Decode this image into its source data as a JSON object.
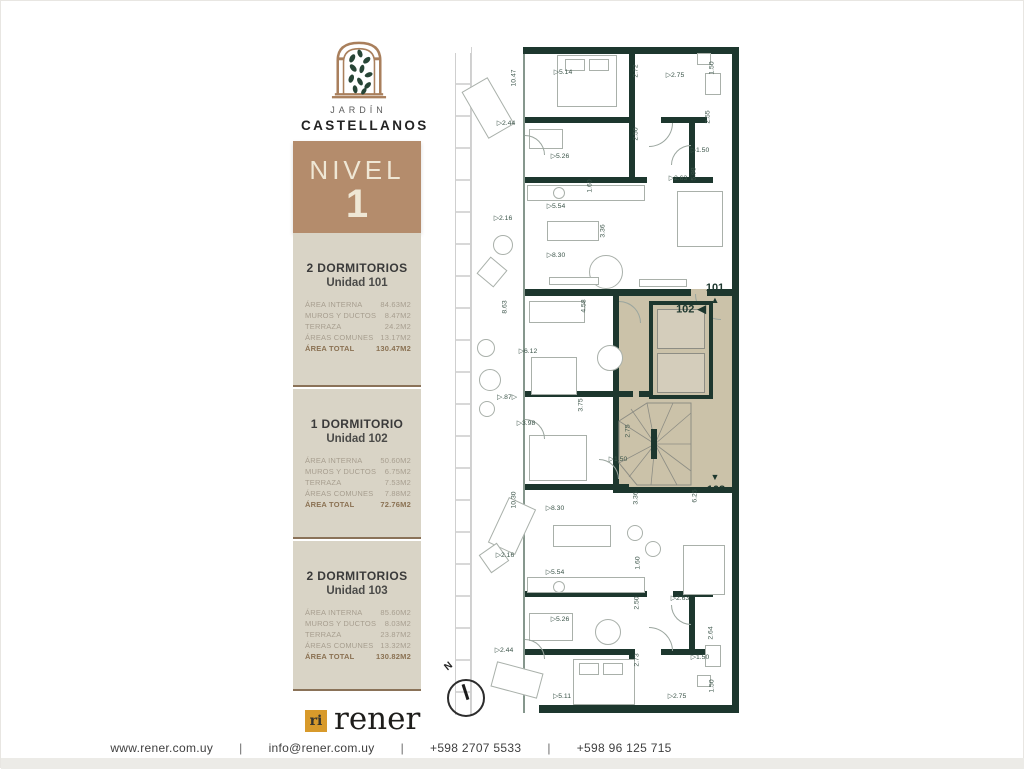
{
  "brand": {
    "name_top": "JARDÍN",
    "name_bottom": "CASTELLANOS"
  },
  "level_badge": {
    "label": "NIVEL",
    "number": "1",
    "bg": "#b48c6c"
  },
  "units": [
    {
      "title": "2 DORMITORIOS",
      "subtitle": "Unidad 101",
      "rows": [
        {
          "label": "ÁREA INTERNA",
          "value": "84.63m2"
        },
        {
          "label": "MUROS Y DUCTOS",
          "value": "8.47m2"
        },
        {
          "label": "TERRAZA",
          "value": "24.2m2"
        },
        {
          "label": "ÁREAS COMUNES",
          "value": "13.17m2"
        }
      ],
      "total": {
        "label": "ÁREA TOTAL",
        "value": "130.47m2"
      }
    },
    {
      "title": "1 DORMITORIO",
      "subtitle": "Unidad 102",
      "rows": [
        {
          "label": "ÁREA INTERNA",
          "value": "50.60m2"
        },
        {
          "label": "MUROS Y DUCTOS",
          "value": "6.75m2"
        },
        {
          "label": "TERRAZA",
          "value": "7.53m2"
        },
        {
          "label": "ÁREAS COMUNES",
          "value": "7.88m2"
        }
      ],
      "total": {
        "label": "ÁREA TOTAL",
        "value": "72.76m2"
      }
    },
    {
      "title": "2 DORMITORIOS",
      "subtitle": "Unidad 103",
      "rows": [
        {
          "label": "ÁREA INTERNA",
          "value": "85.60m2"
        },
        {
          "label": "MUROS Y DUCTOS",
          "value": "8.03m2"
        },
        {
          "label": "TERRAZA",
          "value": "23.87m2"
        },
        {
          "label": "ÁREAS COMUNES",
          "value": "13.32m2"
        }
      ],
      "total": {
        "label": "ÁREA TOTAL",
        "value": "130.82m2"
      }
    }
  ],
  "footer_logo": {
    "mark": "ri",
    "name": "rener",
    "square_color": "#d89a2b"
  },
  "footer": {
    "separator": "|",
    "items": [
      "www.rener.com.uy",
      "info@rener.com.uy",
      "+598 2707 5533",
      "+598 96 125 715"
    ]
  },
  "floorplan": {
    "wall_color": "#1d372e",
    "highlight_color": "#cbc2a9",
    "compass_label": "N",
    "markers": [
      {
        "label": "101",
        "x": 262,
        "y": 249,
        "arrow": "▲",
        "ax": 262,
        "ay": 261
      },
      {
        "label": "102 ◀",
        "x": 238,
        "y": 270,
        "arrow": "",
        "ax": 0,
        "ay": 0
      },
      {
        "label": "103",
        "x": 263,
        "y": 451,
        "arrow": "▼",
        "ax": 262,
        "ay": 438
      }
    ],
    "dimensions": [
      {
        "t": "10.47",
        "x": 61,
        "y": 39,
        "v": true
      },
      {
        "t": "▷5.14",
        "x": 110,
        "y": 33,
        "v": false
      },
      {
        "t": "2.72",
        "x": 183,
        "y": 32,
        "v": true
      },
      {
        "t": "▷2.75",
        "x": 222,
        "y": 36,
        "v": false
      },
      {
        "t": "1.50",
        "x": 259,
        "y": 29,
        "v": true
      },
      {
        "t": "▷2.44",
        "x": 53,
        "y": 84,
        "v": false
      },
      {
        "t": "2.50",
        "x": 183,
        "y": 95,
        "v": true
      },
      {
        "t": "▷5.26",
        "x": 107,
        "y": 117,
        "v": false
      },
      {
        "t": "2.55",
        "x": 255,
        "y": 78,
        "v": true
      },
      {
        "t": "▷1.50",
        "x": 247,
        "y": 111,
        "v": false
      },
      {
        "t": "5.98",
        "x": 241,
        "y": 135,
        "v": true
      },
      {
        "t": "▷2.63",
        "x": 225,
        "y": 139,
        "v": false
      },
      {
        "t": "1.60",
        "x": 137,
        "y": 147,
        "v": true
      },
      {
        "t": "▷5.54",
        "x": 103,
        "y": 167,
        "v": false
      },
      {
        "t": "▷2.16",
        "x": 50,
        "y": 179,
        "v": false
      },
      {
        "t": "3.36",
        "x": 150,
        "y": 192,
        "v": true
      },
      {
        "t": "▷8.30",
        "x": 103,
        "y": 216,
        "v": false
      },
      {
        "t": "8.63",
        "x": 52,
        "y": 268,
        "v": true
      },
      {
        "t": "4.58",
        "x": 131,
        "y": 267,
        "v": true
      },
      {
        "t": "▷6.12",
        "x": 75,
        "y": 312,
        "v": false
      },
      {
        "t": "▷.87▷",
        "x": 54,
        "y": 358,
        "v": false
      },
      {
        "t": "3.75",
        "x": 128,
        "y": 366,
        "v": true
      },
      {
        "t": "▷3.98",
        "x": 73,
        "y": 384,
        "v": false
      },
      {
        "t": "2.75",
        "x": 175,
        "y": 392,
        "v": true
      },
      {
        "t": "▷1.50",
        "x": 165,
        "y": 420,
        "v": false
      },
      {
        "t": "10.30",
        "x": 61,
        "y": 461,
        "v": true
      },
      {
        "t": "3.36",
        "x": 183,
        "y": 459,
        "v": true
      },
      {
        "t": "6.25",
        "x": 242,
        "y": 457,
        "v": true
      },
      {
        "t": "▷8.30",
        "x": 102,
        "y": 469,
        "v": false
      },
      {
        "t": "▷2.16",
        "x": 52,
        "y": 516,
        "v": false
      },
      {
        "t": "1.60",
        "x": 185,
        "y": 524,
        "v": true
      },
      {
        "t": "▷5.54",
        "x": 102,
        "y": 533,
        "v": false
      },
      {
        "t": "▷2.63",
        "x": 227,
        "y": 559,
        "v": false
      },
      {
        "t": "2.50",
        "x": 184,
        "y": 564,
        "v": true
      },
      {
        "t": "▷5.26",
        "x": 107,
        "y": 580,
        "v": false
      },
      {
        "t": "▷2.44",
        "x": 51,
        "y": 611,
        "v": false
      },
      {
        "t": "2.73",
        "x": 184,
        "y": 621,
        "v": true
      },
      {
        "t": "2.64",
        "x": 258,
        "y": 594,
        "v": true
      },
      {
        "t": "▷1.50",
        "x": 247,
        "y": 618,
        "v": false
      },
      {
        "t": "▷5.11",
        "x": 109,
        "y": 657,
        "v": false
      },
      {
        "t": "▷2.75",
        "x": 224,
        "y": 657,
        "v": false
      },
      {
        "t": "1.50",
        "x": 259,
        "y": 647,
        "v": true
      }
    ],
    "walls": [
      {
        "x": 70,
        "y": 8,
        "w": 216,
        "h": 7
      },
      {
        "x": 279,
        "y": 8,
        "w": 7,
        "h": 666
      },
      {
        "x": 86,
        "y": 666,
        "w": 200,
        "h": 8
      },
      {
        "x": 72,
        "y": 78,
        "w": 110,
        "h": 6
      },
      {
        "x": 208,
        "y": 78,
        "w": 46,
        "h": 6
      },
      {
        "x": 176,
        "y": 8,
        "w": 6,
        "h": 76
      },
      {
        "x": 72,
        "y": 138,
        "w": 122,
        "h": 6
      },
      {
        "x": 220,
        "y": 138,
        "w": 40,
        "h": 6
      },
      {
        "x": 176,
        "y": 84,
        "w": 6,
        "h": 60
      },
      {
        "x": 236,
        "y": 84,
        "w": 6,
        "h": 60
      },
      {
        "x": 72,
        "y": 250,
        "w": 166,
        "h": 7
      },
      {
        "x": 254,
        "y": 250,
        "w": 32,
        "h": 7
      },
      {
        "x": 160,
        "y": 257,
        "w": 6,
        "h": 196
      },
      {
        "x": 160,
        "y": 448,
        "w": 126,
        "h": 6
      },
      {
        "x": 72,
        "y": 352,
        "w": 108,
        "h": 6
      },
      {
        "x": 72,
        "y": 445,
        "w": 104,
        "h": 6
      },
      {
        "x": 72,
        "y": 552,
        "w": 122,
        "h": 6
      },
      {
        "x": 220,
        "y": 552,
        "w": 40,
        "h": 6
      },
      {
        "x": 72,
        "y": 610,
        "w": 110,
        "h": 6
      },
      {
        "x": 208,
        "y": 610,
        "w": 46,
        "h": 6
      },
      {
        "x": 176,
        "y": 616,
        "w": 6,
        "h": 58
      },
      {
        "x": 236,
        "y": 556,
        "w": 6,
        "h": 60
      },
      {
        "x": 186,
        "y": 352,
        "w": 52,
        "h": 6
      }
    ],
    "furniture": [
      {
        "t": "rect",
        "x": 104,
        "y": 16,
        "w": 60,
        "h": 52
      },
      {
        "t": "rect",
        "x": 112,
        "y": 20,
        "w": 20,
        "h": 12
      },
      {
        "t": "rect",
        "x": 136,
        "y": 20,
        "w": 20,
        "h": 12
      },
      {
        "t": "rect",
        "x": 76,
        "y": 90,
        "w": 34,
        "h": 20
      },
      {
        "t": "rect",
        "x": 74,
        "y": 146,
        "w": 118,
        "h": 16
      },
      {
        "t": "circle",
        "x": 100,
        "y": 148,
        "w": 12,
        "h": 12
      },
      {
        "t": "rect",
        "x": 224,
        "y": 152,
        "w": 46,
        "h": 56
      },
      {
        "t": "rect",
        "x": 94,
        "y": 182,
        "w": 52,
        "h": 20
      },
      {
        "t": "circle",
        "x": 136,
        "y": 216,
        "w": 34,
        "h": 34
      },
      {
        "t": "rect",
        "x": 96,
        "y": 238,
        "w": 50,
        "h": 8
      },
      {
        "t": "rect",
        "x": 186,
        "y": 240,
        "w": 48,
        "h": 8
      },
      {
        "t": "rect",
        "x": 76,
        "y": 262,
        "w": 56,
        "h": 22
      },
      {
        "t": "circle",
        "x": 144,
        "y": 306,
        "w": 26,
        "h": 26
      },
      {
        "t": "rect",
        "x": 78,
        "y": 318,
        "w": 46,
        "h": 38
      },
      {
        "t": "rect",
        "x": 76,
        "y": 396,
        "w": 58,
        "h": 46
      },
      {
        "t": "rect",
        "x": 100,
        "y": 486,
        "w": 58,
        "h": 22
      },
      {
        "t": "circle",
        "x": 174,
        "y": 486,
        "w": 16,
        "h": 16
      },
      {
        "t": "circle",
        "x": 192,
        "y": 502,
        "w": 16,
        "h": 16
      },
      {
        "t": "rect",
        "x": 230,
        "y": 506,
        "w": 42,
        "h": 50
      },
      {
        "t": "rect",
        "x": 74,
        "y": 538,
        "w": 118,
        "h": 16
      },
      {
        "t": "circle",
        "x": 100,
        "y": 542,
        "w": 12,
        "h": 12
      },
      {
        "t": "rect",
        "x": 76,
        "y": 574,
        "w": 44,
        "h": 28
      },
      {
        "t": "circle",
        "x": 142,
        "y": 580,
        "w": 26,
        "h": 26
      },
      {
        "t": "rect",
        "x": 120,
        "y": 620,
        "w": 62,
        "h": 46
      },
      {
        "t": "rect",
        "x": 126,
        "y": 624,
        "w": 20,
        "h": 12
      },
      {
        "t": "rect",
        "x": 150,
        "y": 624,
        "w": 20,
        "h": 12
      },
      {
        "t": "rect",
        "x": 244,
        "y": 14,
        "w": 14,
        "h": 12
      },
      {
        "t": "rect",
        "x": 252,
        "y": 34,
        "w": 16,
        "h": 22
      },
      {
        "t": "rect",
        "x": 244,
        "y": 636,
        "w": 14,
        "h": 12
      },
      {
        "t": "rect",
        "x": 252,
        "y": 606,
        "w": 16,
        "h": 22
      },
      {
        "t": "rrect",
        "x": 20,
        "y": 42,
        "w": 30,
        "h": 54,
        "r": -30
      },
      {
        "t": "circle",
        "x": 40,
        "y": 196,
        "w": 20,
        "h": 20
      },
      {
        "t": "rrect",
        "x": 28,
        "y": 222,
        "w": 22,
        "h": 22,
        "r": 40
      },
      {
        "t": "circle",
        "x": 24,
        "y": 300,
        "w": 18,
        "h": 18
      },
      {
        "t": "circle",
        "x": 26,
        "y": 330,
        "w": 22,
        "h": 22
      },
      {
        "t": "circle",
        "x": 26,
        "y": 362,
        "w": 16,
        "h": 16
      },
      {
        "t": "rrect",
        "x": 44,
        "y": 462,
        "w": 30,
        "h": 50,
        "r": 25
      },
      {
        "t": "rrect",
        "x": 30,
        "y": 508,
        "w": 22,
        "h": 22,
        "r": -35
      },
      {
        "t": "rrect",
        "x": 40,
        "y": 628,
        "w": 48,
        "h": 26,
        "r": 15
      }
    ],
    "arcs": [
      {
        "x": 196,
        "y": 84,
        "r": 24,
        "dir": "br"
      },
      {
        "x": 218,
        "y": 106,
        "r": 20,
        "dir": "tl"
      },
      {
        "x": 242,
        "y": 255,
        "r": 26,
        "dir": "bl"
      },
      {
        "x": 166,
        "y": 262,
        "r": 22,
        "dir": "tr"
      },
      {
        "x": 146,
        "y": 420,
        "r": 20,
        "dir": "tr"
      },
      {
        "x": 196,
        "y": 588,
        "r": 24,
        "dir": "tr"
      },
      {
        "x": 218,
        "y": 566,
        "r": 20,
        "dir": "bl"
      },
      {
        "x": 72,
        "y": 96,
        "r": 20,
        "dir": "tr"
      },
      {
        "x": 72,
        "y": 380,
        "r": 20,
        "dir": "tr"
      },
      {
        "x": 72,
        "y": 600,
        "r": 20,
        "dir": "tr"
      }
    ]
  }
}
